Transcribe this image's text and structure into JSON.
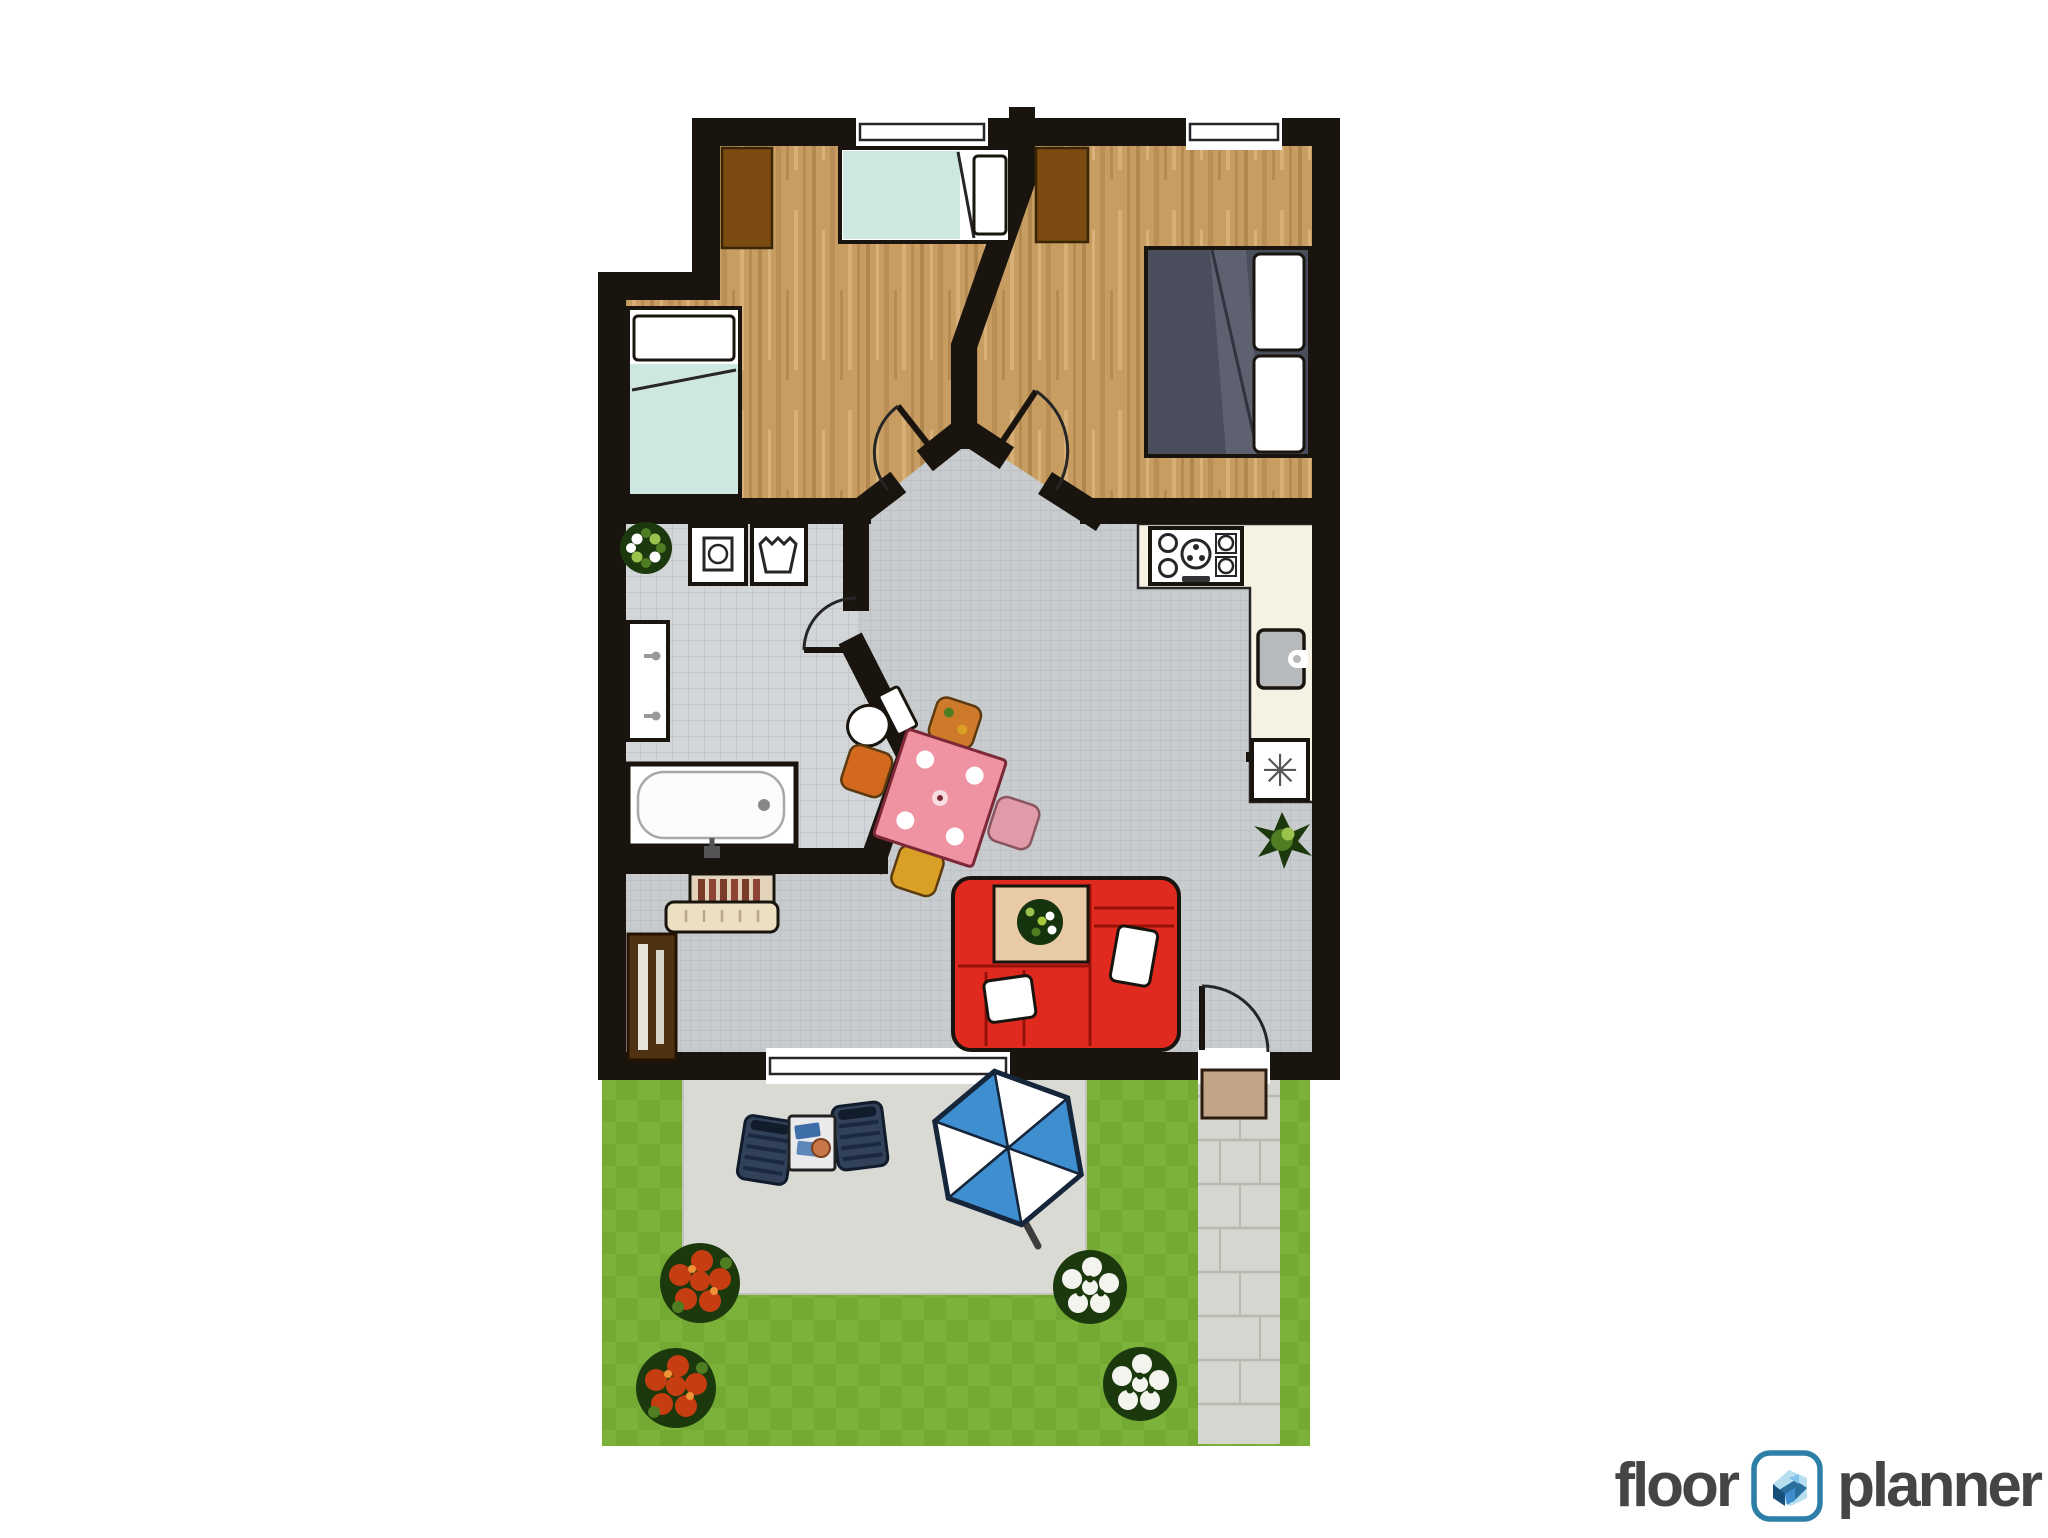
{
  "logo": {
    "part1": "floor",
    "part2": "planner",
    "icon": "floorplanner-house-icon"
  },
  "symbols": {
    "freezer": "✳"
  },
  "rooms": [
    "bedroom-top-left",
    "bedroom-top-right",
    "bathroom",
    "hallway",
    "kitchen",
    "living-room",
    "garden",
    "patio",
    "garden-path"
  ],
  "furniture": [
    "single-bed",
    "single-bed",
    "double-bed",
    "wardrobe",
    "wardrobe",
    "washing-machine",
    "laundry-basket",
    "sink-vanity",
    "bathtub",
    "toilet",
    "stove",
    "kitchen-sink",
    "freezer",
    "dining-table",
    "dining-chairs",
    "corner-sofa-red",
    "coffee-table",
    "piano",
    "bookshelf",
    "potted-plants",
    "lounge-chairs",
    "side-table",
    "parasol",
    "flower-bushes",
    "doormat"
  ],
  "colors": {
    "wall": "#1a140e",
    "ink": "#262626",
    "wood": "#c79d62",
    "woodDark": "#a87e49",
    "woodLight": "#d9b279",
    "tile": "#c9ccce",
    "tileLine": "#b4b7ba",
    "bath": "#d3d6d9",
    "bathLine": "#bfc2c5",
    "counter": "#f5f1e3",
    "steel": "#b7babd",
    "grass": "#74a934",
    "grassLight": "#7cb23a",
    "patio": "#dadad5",
    "path": "#d6d6d1",
    "pathLine": "#b9b9b2",
    "mat": "#c3a486",
    "matEdge": "#2a1c10",
    "red": "#e02a20",
    "redSeam": "#991009",
    "teal": "#cfe7e1",
    "darkbed": "#4a4e5c",
    "bedshade": "#5d6170",
    "bedfold": "#30343f",
    "brown": "#7b4b12",
    "brownEdge": "#3a2505",
    "pink": "#ef93a2",
    "pinkEdge": "#7c2836",
    "chairOrange": "#cf7a2a",
    "chairRust": "#d2691e",
    "chairYellow": "#daa025",
    "chairPink": "#e09aa8",
    "tan": "#e8caa6",
    "plantDark": "#1c380d",
    "plantMid": "#4e7d22",
    "plantLight": "#9cc24e",
    "navy": "#31415a",
    "navyDark": "#101b2b",
    "navySlat": "#1b2940",
    "blue": "#3e8ed0",
    "white": "#ffffff",
    "flower": "#c63d12",
    "flowerHi": "#f09238",
    "petalWhite": "#f4f4ef",
    "logoText": "#454545",
    "logoTeal": "#2d7fa8"
  }
}
